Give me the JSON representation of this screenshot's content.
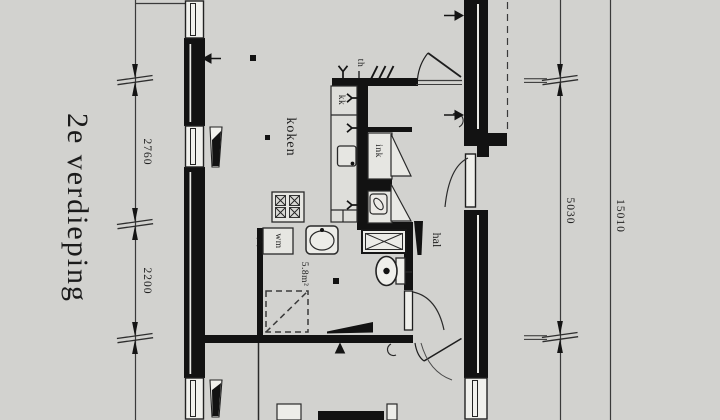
{
  "floor_title": "2e verdieping",
  "room_labels": {
    "kitchen": "koken",
    "hall": "hal",
    "bathroom_area": "5.8m²"
  },
  "fixture_labels": {
    "fridge": "kk",
    "flue": "th",
    "closet": "ink",
    "washing_machine": "wm"
  },
  "dimensions": {
    "left_upper": "2760",
    "left_lower": "2200",
    "right_inner": "5030",
    "right_overall": "15010"
  },
  "colors": {
    "background": "#d2d2cf",
    "wall": "#121212",
    "line": "#2a2a2a",
    "fixture_fill": "#ebebe7"
  }
}
